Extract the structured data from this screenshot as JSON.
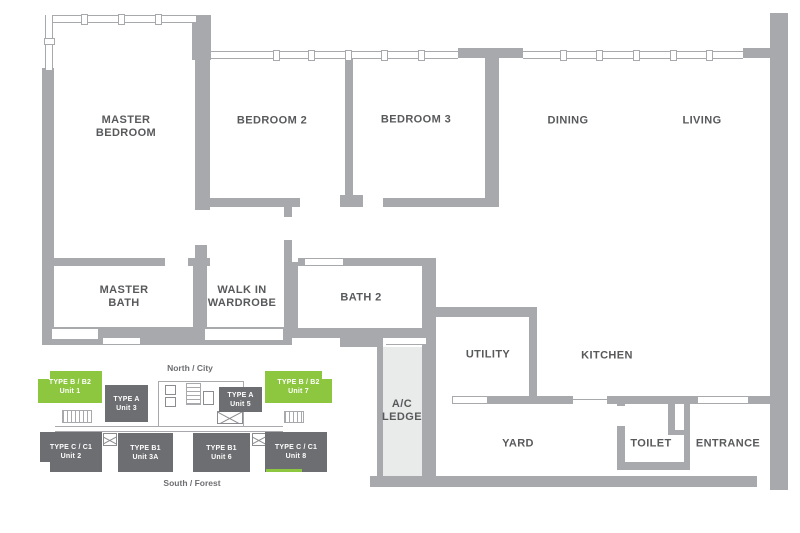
{
  "floor_plan": {
    "rooms": {
      "master_bedroom": {
        "line1": "MASTER",
        "line2": "BEDROOM"
      },
      "bedroom_2": {
        "line1": "BEDROOM 2"
      },
      "bedroom_3": {
        "line1": "BEDROOM 3"
      },
      "dining": {
        "line1": "DINING"
      },
      "living": {
        "line1": "LIVING"
      },
      "master_bath": {
        "line1": "MASTER",
        "line2": "BATH"
      },
      "walk_in_wardrobe": {
        "line1": "WALK IN",
        "line2": "WARDROBE"
      },
      "bath_2": {
        "line1": "BATH 2"
      },
      "utility": {
        "line1": "UTILITY"
      },
      "kitchen": {
        "line1": "KITCHEN"
      },
      "ac_ledge": {
        "line1": "A/C",
        "line2": "LEDGE"
      },
      "yard": {
        "line1": "YARD"
      },
      "toilet": {
        "line1": "TOILET"
      },
      "entrance": {
        "line1": "ENTRANCE"
      }
    }
  },
  "key_plan": {
    "north_label": "North / City",
    "south_label": "South / Forest",
    "units": {
      "unit_1": {
        "type": "TYPE B / B2",
        "unit": "Unit 1",
        "highlighted": true
      },
      "unit_3": {
        "type": "TYPE A",
        "unit": "Unit 3",
        "highlighted": false
      },
      "unit_5": {
        "type": "TYPE A",
        "unit": "Unit 5",
        "highlighted": false
      },
      "unit_7": {
        "type": "TYPE B / B2",
        "unit": "Unit 7",
        "highlighted": true
      },
      "unit_2": {
        "type": "TYPE C / C1",
        "unit": "Unit 2",
        "highlighted": false
      },
      "unit_3a": {
        "type": "TYPE B1",
        "unit": "Unit 3A",
        "highlighted": false
      },
      "unit_6": {
        "type": "TYPE B1",
        "unit": "Unit 6",
        "highlighted": false
      },
      "unit_8": {
        "type": "TYPE C / C1",
        "unit": "Unit 8",
        "highlighted": false
      }
    }
  },
  "colors": {
    "wall_gray": "#A7A9AC",
    "highlight_green": "#8DC63F",
    "unit_gray": "#6D6E71",
    "label_text": "#58595B",
    "ledge_fill": "#E9EAEA"
  }
}
